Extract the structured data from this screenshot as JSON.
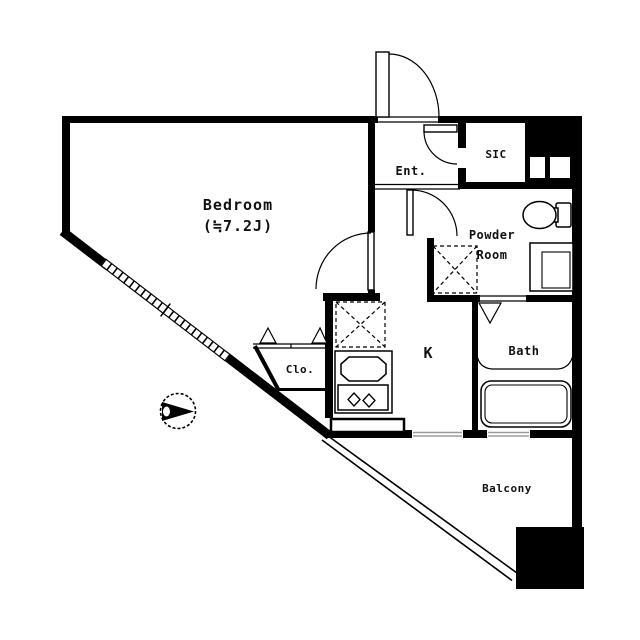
{
  "title": "Apartment floor plan",
  "colors": {
    "wall": "#000000",
    "background": "#ffffff",
    "line": "#111111",
    "window_track": "#9b9b9b"
  },
  "rooms": {
    "bedroom": {
      "name": "Bedroom",
      "size": "(≒7.2J)"
    },
    "entrance": {
      "name": "Ent."
    },
    "sic": {
      "name": "SIC"
    },
    "powder_room": {
      "name_line1": "Powder",
      "name_line2": "Room"
    },
    "bath": {
      "name": "Bath"
    },
    "kitchen": {
      "name": "K"
    },
    "closet": {
      "name": "Clo."
    },
    "balcony": {
      "name": "Balcony"
    }
  },
  "symbols": [
    "entrance-door-swing",
    "sic-door-swing",
    "hall-door-swing",
    "bedroom-door-swing",
    "bath-folding-door",
    "toilet",
    "vanity-sink",
    "washing-machine-space",
    "refrigerator-space",
    "kitchen-sink",
    "stove-two-burner",
    "bathtub",
    "closet-bifold-doors",
    "diagonal-window",
    "balcony-railing",
    "balcony-sliding-windows",
    "north-arrow-compass",
    "pipe-shafts"
  ]
}
